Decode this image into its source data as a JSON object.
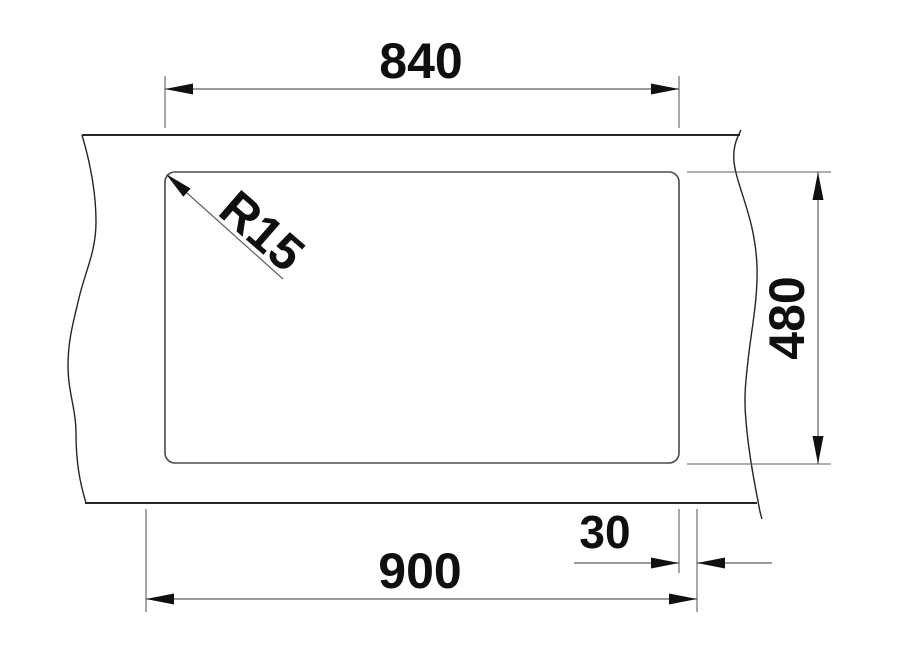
{
  "drawing": {
    "dimension_labels": {
      "cutout_width": "840",
      "cutout_height": "480",
      "overall_width": "900",
      "reveal_offset": "30",
      "corner_radius": "R15"
    },
    "colors": {
      "background": "#ffffff",
      "outline": "#262626",
      "cutout": "#4a4a4a",
      "dimension_line": "#5f5f5f",
      "arrow": "#101010",
      "text": "#0f0f0f"
    }
  }
}
